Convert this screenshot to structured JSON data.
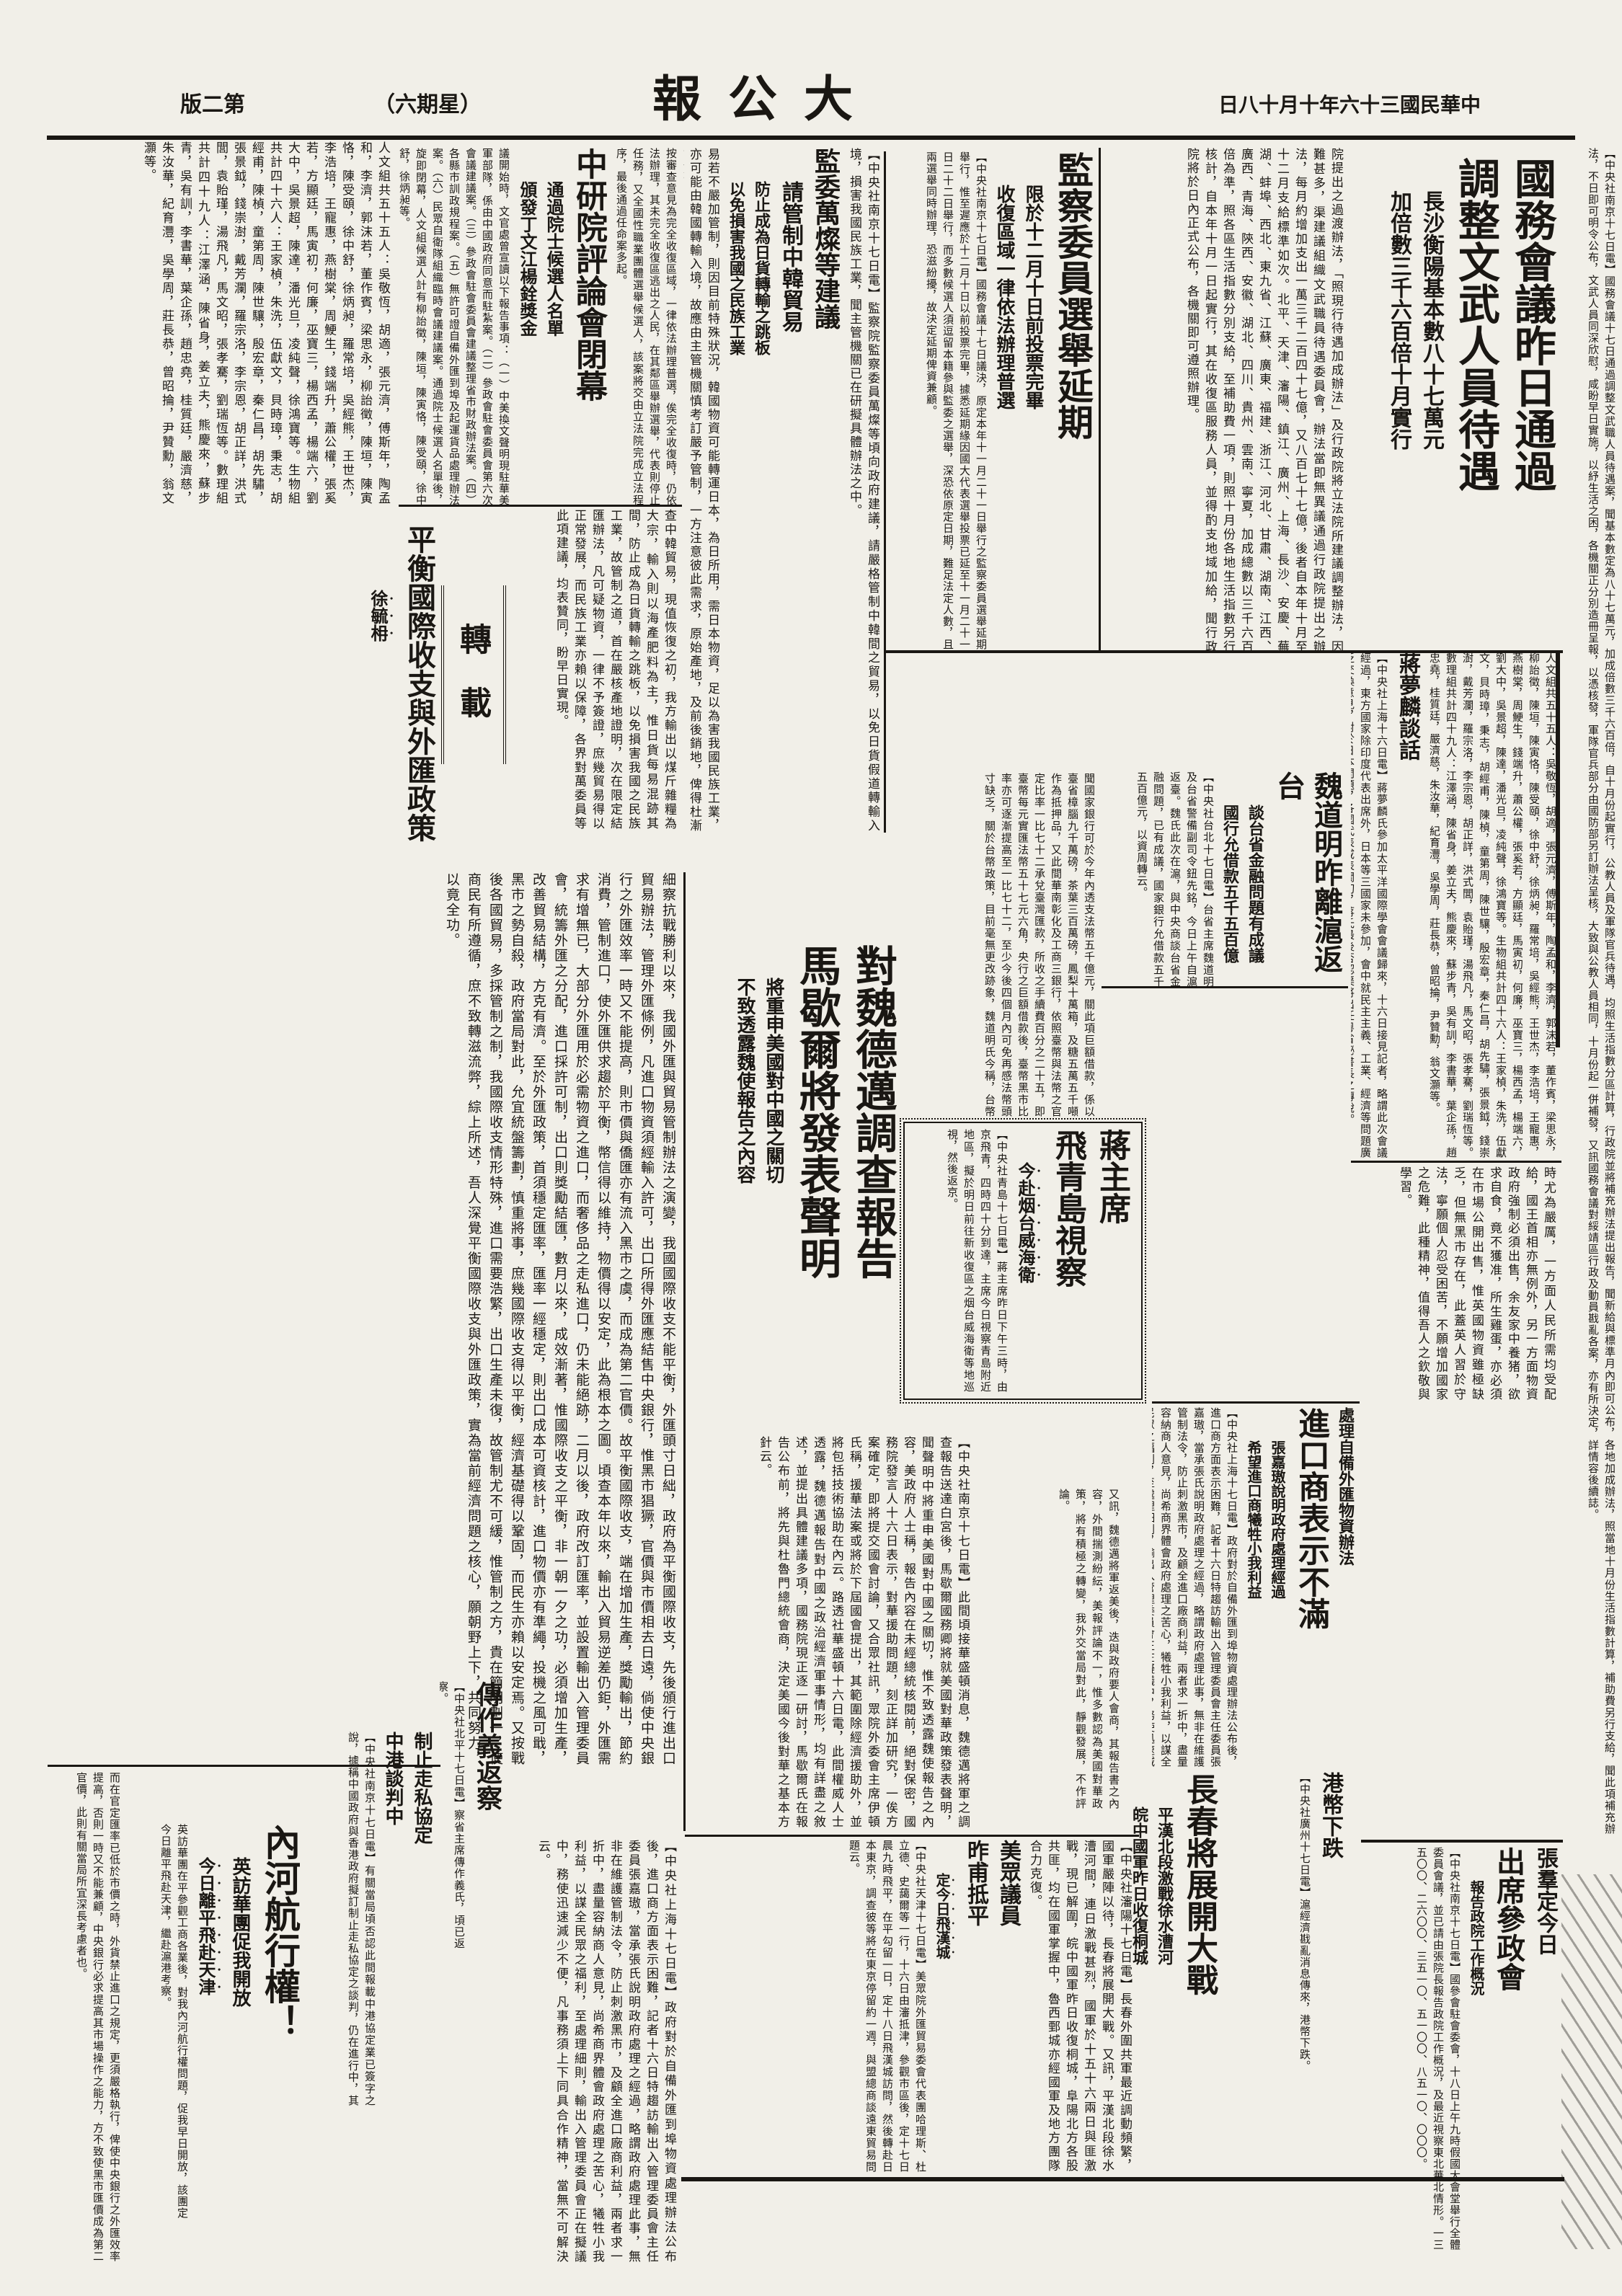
{
  "page": {
    "edition": "版二第",
    "weekday": "（六期星）",
    "masthead": "報 公 大",
    "date": "日八十月十年六十三國民華中"
  },
  "a": {
    "lead": {
      "body": "【中央社南京十七日電】國務會議十七日通過調整文武職人員待遇案，聞基本數定為八十七萬元，加成倍數三千六百倍，自十月份起實行，公教人員及軍隊官兵待遇，均照生活指數分區計算，行政院並將補充辦法提出報告，聞新給與標準月內即可公布，各地加成辦法，照當地十月份生活指數計算，補助費另行支給，聞此項補充辦法，不日即可明令公布，文武人員同深欣慰，咸盼早日實施，以紓生活之困，各機關正分別造冊呈報，以憑核發，軍隊官兵部分由國防部另訂辦法呈核，大致與公教人員相同，十月份起一併補發，又訊國務會議對綏靖區行政及動員戡亂各案，亦有所決定，詳情容後續誌。"
    },
    "guowu": {
      "h1": "國務會議昨日通過",
      "h2": "調整文武人員待遇",
      "s1": "長沙衡陽基本數八十七萬元",
      "s2": "加倍數三千六百倍十月實行",
      "body": "院提出之過渡辦法，「照現行待遇加成辦法」及行政院將立法院所建議調整辦法，因難甚多，渠建議組織文武職員待遇委員會，辦法當即無異議通過行政院提出之辦法，每月約增加支出一萬三千二百四十七億，又八百七十七億，後者自本年十月至十二月支給標準如次。北平、天津、瀋陽、鎮江、廣州、上海、長沙、安慶、蕪湖、蚌埠、西北、東九省、江蘇、廣東、福建、浙江、河北、甘肅、湖南、江西、廣西、青海、陝西、安徽、湖北、四川、貴州、雲南、寧夏，加成總數以三千六百倍為準，照各區生活指數分別支給，至補助費一項，則照十月份各地生活指數另行核計，自本年十月一日起實行，其在收復區服務人員，並得酌支地域加給，聞行政院將於日內正式公布，各機關即可遵照辦理。"
    },
    "jiancha": {
      "h": "監察委員選舉延期",
      "s1": "限於十二月十日前投票完畢",
      "s2": "收復區域一律依法辦理普選",
      "body": "【中央社南京十七日電】國務會議十七日議決，原定本年十一月二十一日舉行之監察委員選舉延期舉行，惟至遲應於十二月十日以前投票完畢，據悉延期緣因國大代表選舉投票已延至十一月二十一日二十二日舉行，而多數候選人須逗留本籍參與監委之選舉，深恐依原定日期，難足法定人數，且兩選舉同時辦理，恐滋紛擾，故決定延期俾資兼顧。"
    },
    "jianwei": {
      "pre": "【中央社南京十七日電】監察院監察委員萬燦等頃向政府建議，請嚴格管制中韓間之貿易，以免日貨假道轉輸入境，損害我國民族工業，聞主管機關已在研擬具體辦法之中。",
      "h": "監委萬燦等建議",
      "s1": "請管制中韓貿易",
      "s2": "防止成為日貨轉輸之跳板",
      "s3": "以免損害我國之民族工業",
      "body": "易若不嚴加管制，則因目前特殊狀況，韓國物資可能轉運日本，為日所用，需日本物資，足以為害我國民族工業，亦可能由韓國轉輸入境，故應由主管機關慎考訂嚴予管制，一方注意彼此需求，原始產地，及前後銷地，俾得杜漸防微。",
      "body2": "查中韓貿易，現值恢復之初，我方輸出以煤斤雜糧為大宗，輸入則以海產肥料為主，惟日貨每易混跡其間，防止成為日貨轉輸之跳板，以免損害我國之民族工業，故管制之道，首在嚴核產地證明，次在限定結匯辦法，凡可疑物資，一律不予簽證，庶幾貿易得以正常發展，而民族工業亦賴以保障，各界對萬委員等此項建議，均表贊同，盼早日實現。"
    },
    "yanjiuyuan": {
      "pre": "按審查意見為完全收復區域，一律依法辦理普選，俟完全收復時，仍依法辦理，其未完全收復區逃出之人民，在其鄰區舉辦選舉，代表則停止任務，又全國性職業團體選舉候選人，該案將交由立法院完成立法程序，最後通過任命案多起。",
      "h": "中研院評論會閉幕",
      "s1": "通過院士候選人名單",
      "s2": "頒發丁文江楊銓獎金",
      "body": "議開始時，文官處曾宣讀以下報告事項：（一）中美換文聲明現駐華美軍部隊，係由中國政府同意而駐紮案。（二）參政會駐會委員會第六次會議建議案。（三）參政會駐會委員會建議整理省市財政辦法案。（四）各縣市訓政規程案。（五）無許可證自備外匯到埠及起運貨品處理辦法案。（六）民眾自衛隊組織臨時會議建議案。通過院士候選人名單後，旋即閉幕，人文組候選人計有柳詒徵，陳垣，陳寅恪，陳受頤，徐中舒，徐炳昶等。"
    },
    "topleft": {
      "body": "人文組共五十五人：吳敬恆，胡適，張元濟，傅斯年，陶孟和，李濟，郭沫若，董作賓，梁思永，柳詒徵，陳垣，陳寅恪，陳受頤，徐中舒，徐炳昶，羅常培，吳經熊，王世杰，李浩培，王寵惠，燕樹棠，周鯁生，錢端升，蕭公權，張奚若，方顯廷，馬寅初，何廉，巫寶三，楊西孟，楊端六，劉大中，吳景超，陳達，潘光旦，凌純聲，徐鴻寶等。生物組共計四十六人：王家楨，朱洗，伍獻文，貝時璋，秉志，胡經甫，陳楨，童第周，陳世驤，殷宏章，秦仁昌，胡先驌，張景鉞，錢崇澍，戴芳瀾，羅宗洛，李宗恩，胡正詳，洪式閭，袁貽瑾，湯飛凡，馬文昭，張孝騫，劉瑞恆等。數理組共計四十九人：江澤涵，陳省身，姜立夫，熊慶來，蘇步青，吳有訓，李書華，葉企孫，趙忠堯，桂質廷，嚴濟慈，朱汝華，紀育灃，吳學周，莊長恭，曾昭掄，尹贊勳，翁文灝等。"
    },
    "zhuanzai": {
      "label": "轉　載"
    },
    "essay": {
      "title": "平衡國際收支與外匯政策",
      "author": "徐毓枏",
      "body": "細察抗戰勝利以來，我國外匯與貿易管制辦法之演變，我國國際收支不能平衡，外匯頭寸日絀，政府為平衡國際收支，先後頒行進出口貿易辦法，管理外匯條例，凡進口物資須經輸入許可，出口所得外匯應結售中央銀行，惟黑市猖獗，官價與市價相去日遠，倘使中央銀行之外匯效率一時又不能提高，則市價與僑匯亦有流入黑市之虞，而成為第二官價。故平衡國際收支，端在增加生產，獎勵輸出，節約消費，管制進口，使外匯供求趨於平衡，幣信得以維持，物價得以安定，此為根本之圖。頃查本年以來，輸出入貿易逆差仍鉅，外匯需求有增無已，大部分外匯用於必需物資之進口，而奢侈品之走私進口，仍未能絕跡，二月以後，政府改訂匯率，並設置輸出入管理委員會，統籌外匯之分配，進口採許可制，出口則獎勵結匯，數月以來，成效漸著，惟國際收支之平衡，非一朝一夕之功，必須增加生產，改善貿易結構，方克有濟。至於外匯政策，首須穩定匯率，匯率一經穩定，則出口成本可資核計，進口物價亦有準繩，投機之風可戢，黑市之勢自殺，政府當局對此，允宜統盤籌劃，慎重將事，庶幾國際收支得以平衡，經濟基礎得以鞏固，而民生亦賴以安定焉。又按戰後各國貿易，多採管制之制，我國際收支情形特殊，進口需要浩繁，出口生產未復，故管制尤不可緩，惟管制之方，貴在簡明劃一，使商民有所遵循，庶不致轉滋流弊，綜上所述，吾人深覺平衡國際收支與外匯政策，實為當前經濟問題之核心，願朝野上下，共同努力，以竟全功。",
      "cont": "而在官定匯率已低於市價之時，外貨禁止進口之規定，更須嚴格執行，俾使中央銀行之外匯效率提高，否則一時又不能兼顧，中央銀行必求提高其市場操作之能力，方不致使黑市匯價成為第二官價，此則有關當局所宜深長考慮者也。"
    },
    "weidaoming": {
      "h": "魏道明昨離滬返台",
      "s1": "談台省金融問題有成議",
      "s2": "國行允借款五千五百億",
      "body": "【中央社台北十七日電】台省主席魏道明及台省警備副司令鈕先銘，今日上午自滬返臺。魏氏此次在滬，與中央商談台省金融問題，已有成議，國家銀行允借款五千五百億元，以資周轉云。",
      "taibi": "聞國家銀行可於今年內透支法幣五千億元，關此項巨額借款，係以臺省樟腦九千萬磅，茶葉三百萬磅，鳳梨十萬箱，及糖五萬五千噸作為抵押品，又此間華南彰化及工商三銀行，依照臺幣與法幣之官定比率一比七十二承兌臺灣匯款，所收之手續費百分之二十五，即臺幣每元實匯法幣五十七元六角，央行之巨額借款後，臺幣黑市比率亦可逐漸提高至一比七十二，至少今後四個月內可免再感法幣頭寸缺乏，關於台幣政策，目前毫無更改跡象，魏道明氏今稱，台幣政策可使臺灣隔絕省外之經濟活動，對於臺幣與法幣之比率適時予以機動性之調整，魏氏又稱，央行亦已允撥外匯美金九百五十萬元，作為臺省購買外國肥料之用。"
    },
    "jiang": {
      "h1": "蔣主席",
      "h2": "飛青島視察",
      "s": "今赴烟台威海衛",
      "body": "【中央社青島十七日電】蔣主席昨日下午三時，由京飛青，四時四十分到達，主席今日視察青島附近地區，擬於明日前往新收復區之烟台威海衛等地巡視，然後返京。"
    },
    "duiwei": {
      "h1": "對魏德邁調查報告",
      "h2": "馬歇爾將發表聲明",
      "s1": "將重申美國對中國之關切",
      "s2": "不致透露魏使報告之內容",
      "body": "【中央社南京十七日電】此間頃接華盛頓消息，魏德邁將軍之調查報告送達白宮後，馬歇爾國務卿將就美國對華政策發表聲明，聞聲明中將重申美國對中國之關切，惟不致透露魏使報告之內容，美政府人士稱，報告內容在未經總統核閱前，絕對保密，國務院發言人十六日表示，對華援助問題，刻正詳加研究，一俟方案確定，即將提交國會討論，又合眾社訊，眾院外委會主席伊頓氏稱，援華法案或將於下屆國會提出，其範圍除經濟援助外，並將包括技術協助在內云。路透社華盛頓十六日電，此間權威人士透露，魏德邁報告對中國之政治經濟軍事情形，均有詳盡之敘述，並提出具體建議多項，國務院現正逐一研討，馬歇爾氏在報告公布前，將先與杜魯門總統會商，決定美國今後對華之基本方針云。",
      "cont": "又訊，魏德邁將軍返美後，迭與政府要人會商，其報告書之內容，外間揣測紛紜，美報評論不一，惟多數認為美國對華政策，將有積極之轉變，我外交當局對此，靜觀發展，不作評論。"
    },
    "rightmid": {
      "h1": "蔣夢麟談話",
      "talk": "【中央社上海十六日電】蔣夢麟氏參加太平洋國際學會會議歸來，十六日接見記者，略謂此次會議經過，東方國家除印度代表出席外，日本等三國家未參加，會中就民主主義、工業、經濟等問題廣泛交換意見，對於日本問題，各國代表咸表關切，蔣氏最後否認渠將出任粵省祕書長之傳說。",
      "h2": "國民黨黨員",
      "h3": "跨黨者開除",
      "body": "（一）凡本黨黨員未經許可擅自參加其他政黨者，均屬違反本黨紀律，應予開除黨籍。（二）黨員請求脫黨，亦屬違反本黨紀律，經予以開除黨籍之處分。（三）其情節輕微者，惟仍須察看其言行，具報候核，悉照中央頒定之規定辦理。",
      "england": "時尤為嚴厲，一方面人民所需均受配給，國王首相亦無例外，另一方面物資政府強制必須出售，余友家中養猪，欲求自食，竟不獲准，所生雞蛋，亦必須在市場公開出售，惟英國物資雖極缺乏，但無黑市存在，此蓋英人習於守法，寧願個人忍受困苦，不願增加國家之危難，此種精神，值得吾人之欽敬與學習。"
    },
    "chuli": {
      "s1": "處理自備外匯物資辦法",
      "h": "進口商表示不滿",
      "s2": "張嘉璈說明政府處理經過",
      "s3": "希望進口商犧牲小我利益",
      "body": "【中央社上海十七日電】政府對於自備外匯到埠物資處理辦法公布後，進口商方面表示困難，記者十六日特趨訪輸出入管理委員會主任委員張嘉璈，當承張氏說明政府處理之經過，略謂政府處理此事，無非在維護管制法令，防止刺激黑市，及顧全進口廠商利益，兩者求一折中，盡量容納商人意見，尚希商界體會政府處理之苦心，犧牲小我利益，以謀全民眾之福利，至處理細則，輸出入管理委員會正在擬議中，務使迅速減少不便，凡事務須上下同具合作精神，當無不可解決云。"
    },
    "changchun": {
      "h": "長春將展開大戰",
      "s1": "平漢北段激戰徐水漕河",
      "s2": "皖中國軍昨日收復桐城"
    },
    "gangbi": {
      "h": "港幣下跌",
      "body": "【中央社廣州十七日電】滬經濟戡亂消息傳來，港幣下跌。"
    },
    "zhangqun": {
      "h1": "張羣定今日",
      "h2": "出席參政會",
      "s": "報告政院工作概況",
      "body": "【中央社南京十七日電】國參會駐會委會，十八日上午九時假國大會堂舉行全體委員會議，並已請由張院長報告政院工作概況，及最近視察東北華北情形。一三五〇〇、二六〇〇、三五一〇、五一〇〇、八五一〇、〇〇〇。"
    },
    "bottommid": {
      "war": "【中央社瀋陽十七日電】長春外圍共軍最近調動頻繁，國軍嚴陣以待，長春將展開大戰。又訊，平漢北段徐水漕河間，連日激戰甚烈，國軍於十五十六兩日與匪激戰，現已解圍，皖中國軍昨日收復桐城，阜陽北方各股共匪，均在國軍掌握中，魯西鄄城亦經國軍及地方團隊合力克復。",
      "h1": "美眾議員",
      "h2": "昨甫抵平",
      "s": "定今日飛漢城",
      "body": "【中央社天津十七日電】美眾院外匯貿易委會代表團哈理斯、杜立德、史藹爾等一行，十六日由瀋抵津，參觀市區後，定十七日晨九時飛平，在平勾留一日，定十八日飛漢城訪問，然後轉赴日本東京，調查彼等將在東京停留約一週，與盟總商談遠東貿易問題云。"
    },
    "neihe": {
      "h": "內河航行權！",
      "s1": "英訪華團促我開放",
      "s2": "今日離平飛赴天津",
      "body": "英訪華團在平參觀工商各業後，對我內河航行權問題，促我早日開放，該團定今日離平飛赴天津，繼赴滬港考察。"
    },
    "chuanzuoyi": {
      "h": "傳作義返察",
      "body": "【中央社北平十七日電】察省主席傳作義氏，頃已返察。"
    },
    "zousi": {
      "h1": "制止走私協定",
      "h2": "中港談判中",
      "body": "【中央社南京十七日電】有關當局頃否認此間報載中港協定業已簽字之說，據稱中國政府與香港政府擬訂制止走私協定之談判，仍在進行中，其條文內容日內即將公布，尚未有正式簽字云。"
    }
  }
}
